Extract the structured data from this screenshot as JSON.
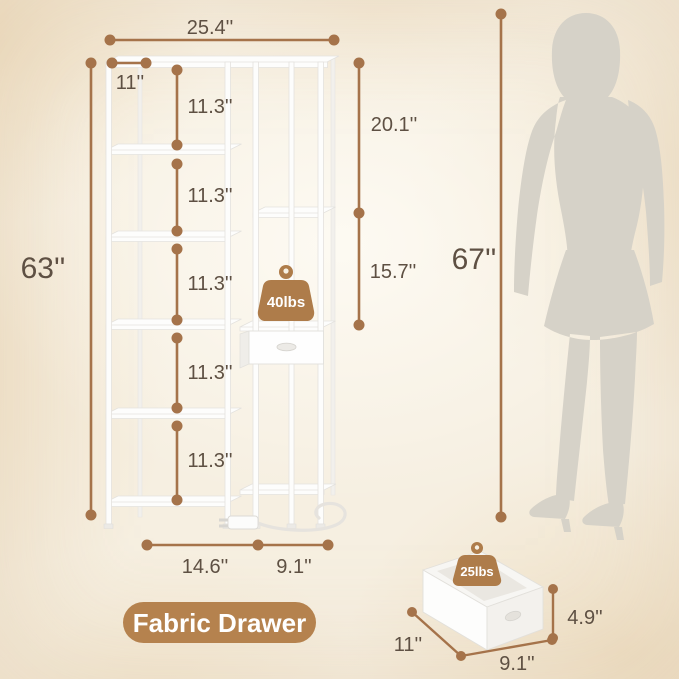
{
  "colors": {
    "dimension_line": "#a5734a",
    "label_text": "#5e5043",
    "badge_fill": "#b5824e",
    "weight_fill": "#ae7c4a",
    "silhouette": "#d6d2c8",
    "product_white": "#fdfdfc",
    "background": "#f6efe1"
  },
  "shelf": {
    "top_width": "25.4''",
    "top_depth": "11''",
    "total_height": "63''",
    "gaps": [
      "11.3''",
      "11.3''",
      "11.3''",
      "11.3''",
      "11.3''"
    ],
    "right_upper_gap": "20.1''",
    "right_lower_gap": "15.7''",
    "base_left_width": "14.6''",
    "base_right_width": "9.1''",
    "shelf_load": "40lbs"
  },
  "person": {
    "height": "67''"
  },
  "drawer": {
    "callout_label": "Fabric Drawer",
    "load": "25lbs",
    "height": "4.9''",
    "depth": "11''",
    "width": "9.1''"
  }
}
